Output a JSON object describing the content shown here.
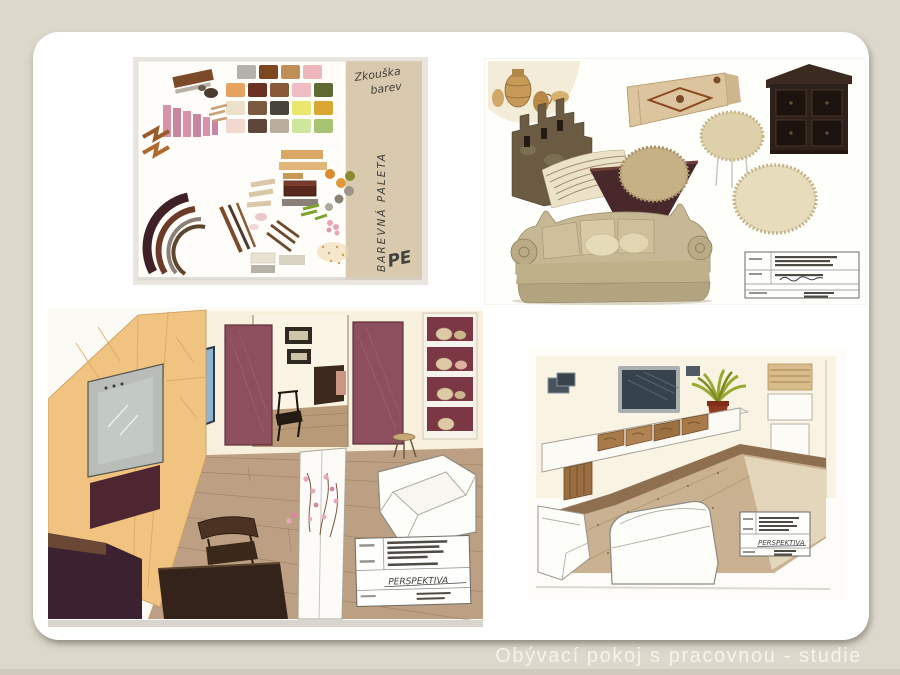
{
  "slide": {
    "caption": "Obývací pokoj s pracovnou - studie",
    "colors": {
      "background": "#dcd8cc",
      "card": "#ffffff",
      "caption_text": "#f6f3ea"
    }
  },
  "color_test_sheet": {
    "note_line1": "Zkouška",
    "note_line2": "barev",
    "side_note": "BAREVNÁ PALETA",
    "signature": "PE",
    "colors": {
      "paper": "#fefdfa",
      "kraft": "#d9c9ae"
    },
    "palette_rows": [
      [
        "#b6b0a8",
        "#7c4621",
        "#c28e58",
        "#edb7bd"
      ],
      [
        "#e5a35f",
        "#6b3020",
        "#8a5a38",
        "#f0bcc4",
        "#5d6b33"
      ],
      [
        "#ece0cb",
        "#7b5a42",
        "#49433d",
        "#eae66e",
        "#d9a832"
      ],
      [
        "#f2d9d0",
        "#5e463a",
        "#b9ae9e",
        "#cfe69e",
        "#a9c375"
      ]
    ]
  },
  "moodboard": {
    "colors": {
      "pottery_bg": "#f3ecd9",
      "wood_panel": "#dcc49e",
      "cabinet_dark": "#2e211b",
      "ruins": "#6b5b42",
      "fabric": "#ebe2c8",
      "bowl": "#48282a",
      "pouf_tan": "#c6b086",
      "pouf_cream": "#ded0ab",
      "pouf_cream_big": "#e7dcbc",
      "sofa": "#c6b894"
    }
  },
  "perspective_large": {
    "titleblock_handwriting": "PERSPEKTIVA",
    "colors": {
      "cabinet_wood": "#f1c381",
      "tv_screen": "#c3c9c5",
      "accent_band": "#4e2631",
      "burgundy_panel": "#8d4e5d",
      "shelf_back": "#7c3744",
      "floor": "#bda083",
      "desk": "#33231a",
      "bench": "#3c2130",
      "blossom": "#e8a8bc",
      "wall": "#f7f0dd"
    }
  },
  "perspective_small": {
    "titleblock_handwriting": "PERSPEKTIVA",
    "colors": {
      "wall": "#f8f3e2",
      "tv": "#37434c",
      "floor": "#c3a985",
      "ridge": "#8e7050",
      "pot": "#8e3a1e",
      "leaves": "#9aa832",
      "drawer_wood": "#a87a4a"
    }
  }
}
